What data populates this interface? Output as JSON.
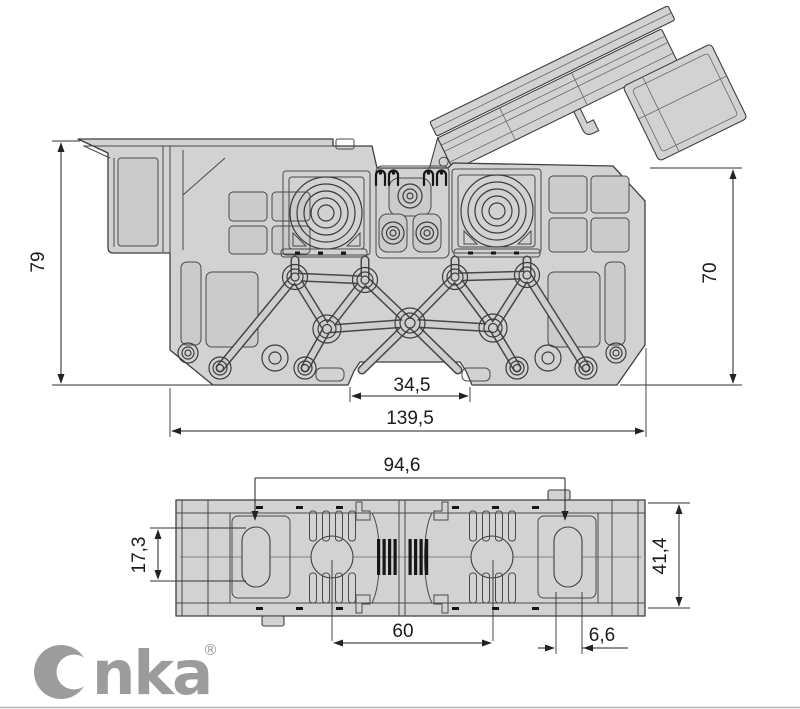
{
  "drawing": {
    "front_view": {
      "height_left": "79",
      "height_right": "70",
      "rail_notch_width": "34,5",
      "overall_width": "139,5"
    },
    "plan_view": {
      "slot_span": "94,6",
      "slot_length": "17,3",
      "overall_depth": "41,4",
      "contact_span": "60",
      "slot_width": "6,6"
    },
    "brand": {
      "name": "Onka",
      "wordmark_tail": "nka",
      "registered": "®"
    },
    "colors": {
      "body": "#d2d2d2",
      "panel": "#cbcbcb",
      "outline": "#3f3f3f",
      "dimension": "#222222",
      "detail_dark": "#161616",
      "logo": "#9c9c9c",
      "background": "#ffffff"
    }
  }
}
